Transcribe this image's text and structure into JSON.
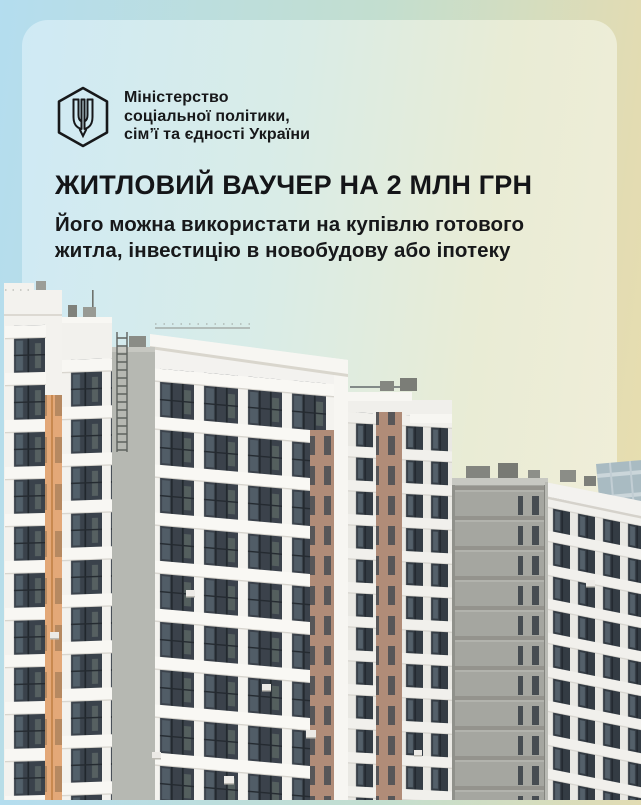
{
  "colors": {
    "frame_gradient": [
      "#b4ddef",
      "#c3decf",
      "#eadfae"
    ],
    "card_gradient": [
      "#cfeaf5",
      "#d9ece7",
      "#f1eed9"
    ],
    "text": "#17181a",
    "orange_accent": "#e3a878",
    "window_glass": "#3a424b"
  },
  "logo": {
    "icon": "tryzub-hexagon-icon",
    "ministry_lines": [
      "Міністерство",
      "соціальної політики,",
      "сім’ї та єдності України"
    ]
  },
  "hero": {
    "headline": "ЖИТЛОВИЙ ВАУЧЕР НА 2 МЛН ГРН",
    "subtitle_lines": [
      "Його можна використати на купівлю готового",
      "житла, інвестицію в новобудову або іпотеку"
    ]
  },
  "photo": {
    "name": "apartment-buildings-photo"
  }
}
